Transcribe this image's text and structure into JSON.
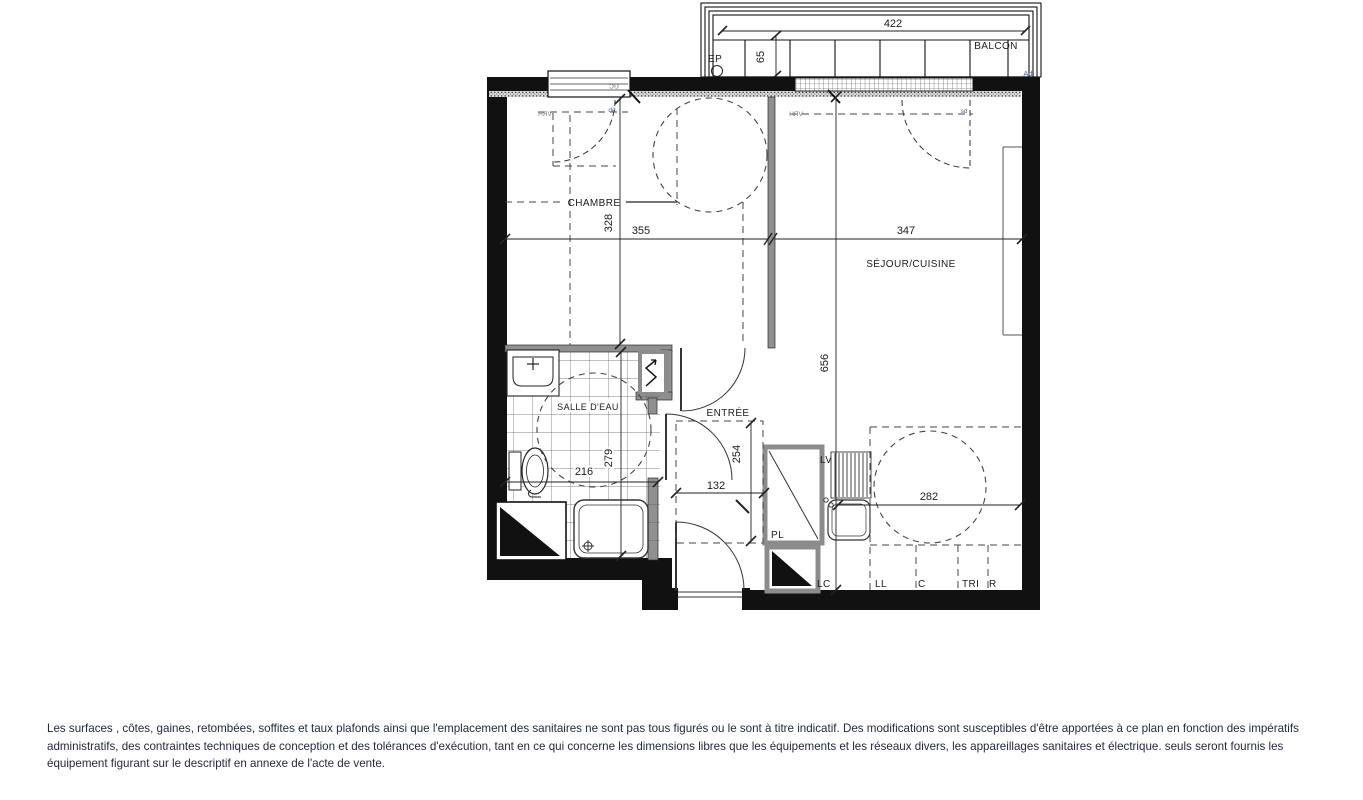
{
  "colors": {
    "wall": "#111111",
    "partition": "#909090",
    "dashed_line": "#444444",
    "dimension_text": "#1c1c1c",
    "annotation_blue": "#3f67a8",
    "disclaimer_text": "#232945"
  },
  "plan": {
    "rooms": {
      "chambre": "CHAMBRE",
      "sejour_cuisine": "SÉJOUR/CUISINE",
      "salle_eau": "SALLE D'EAU",
      "entree": "ENTRÉE",
      "balcon": "BALCON"
    },
    "dimensions_cm": {
      "balcon_width": "422",
      "balcon_depth": "65",
      "chambre_depth": "328",
      "chambre_width": "355",
      "sejour_width": "347",
      "sejour_depth": "656",
      "salle_eau_width": "216",
      "salle_eau_depth": "279",
      "entree_depth": "254",
      "entree_width": "132",
      "cuisine_width": "282"
    },
    "annotations": {
      "ep": "EP",
      "gc": "GC",
      "vrh": "VRH",
      "dd": "dd",
      "sd": "sd",
      "ad": "Ad",
      "pl": "PL",
      "lv": "LV",
      "lc": "LC",
      "ll": "LL",
      "c": "C",
      "tri": "TRI",
      "r": "R"
    }
  },
  "disclaimer": {
    "line1": "Les surfaces , côtes, gaines, retombées, soffites et taux plafonds ainsi que l'emplacement des sanitaires ne sont pas tous figurés ou le sont à titre indicatif. Des modifications sont susceptibles d'être apportées à ce plan en fonction des impératifs",
    "line2": "administratifs, des contraintes techniques de conception et des tolérances d'exécution, tant en ce qui concerne les dimensions libres que les équipements et les réseaux divers, les appareillages sanitaires et électrique. seuls seront fournis les",
    "line3": "équipement figurant sur le descriptif en annexe de l'acte de vente."
  }
}
